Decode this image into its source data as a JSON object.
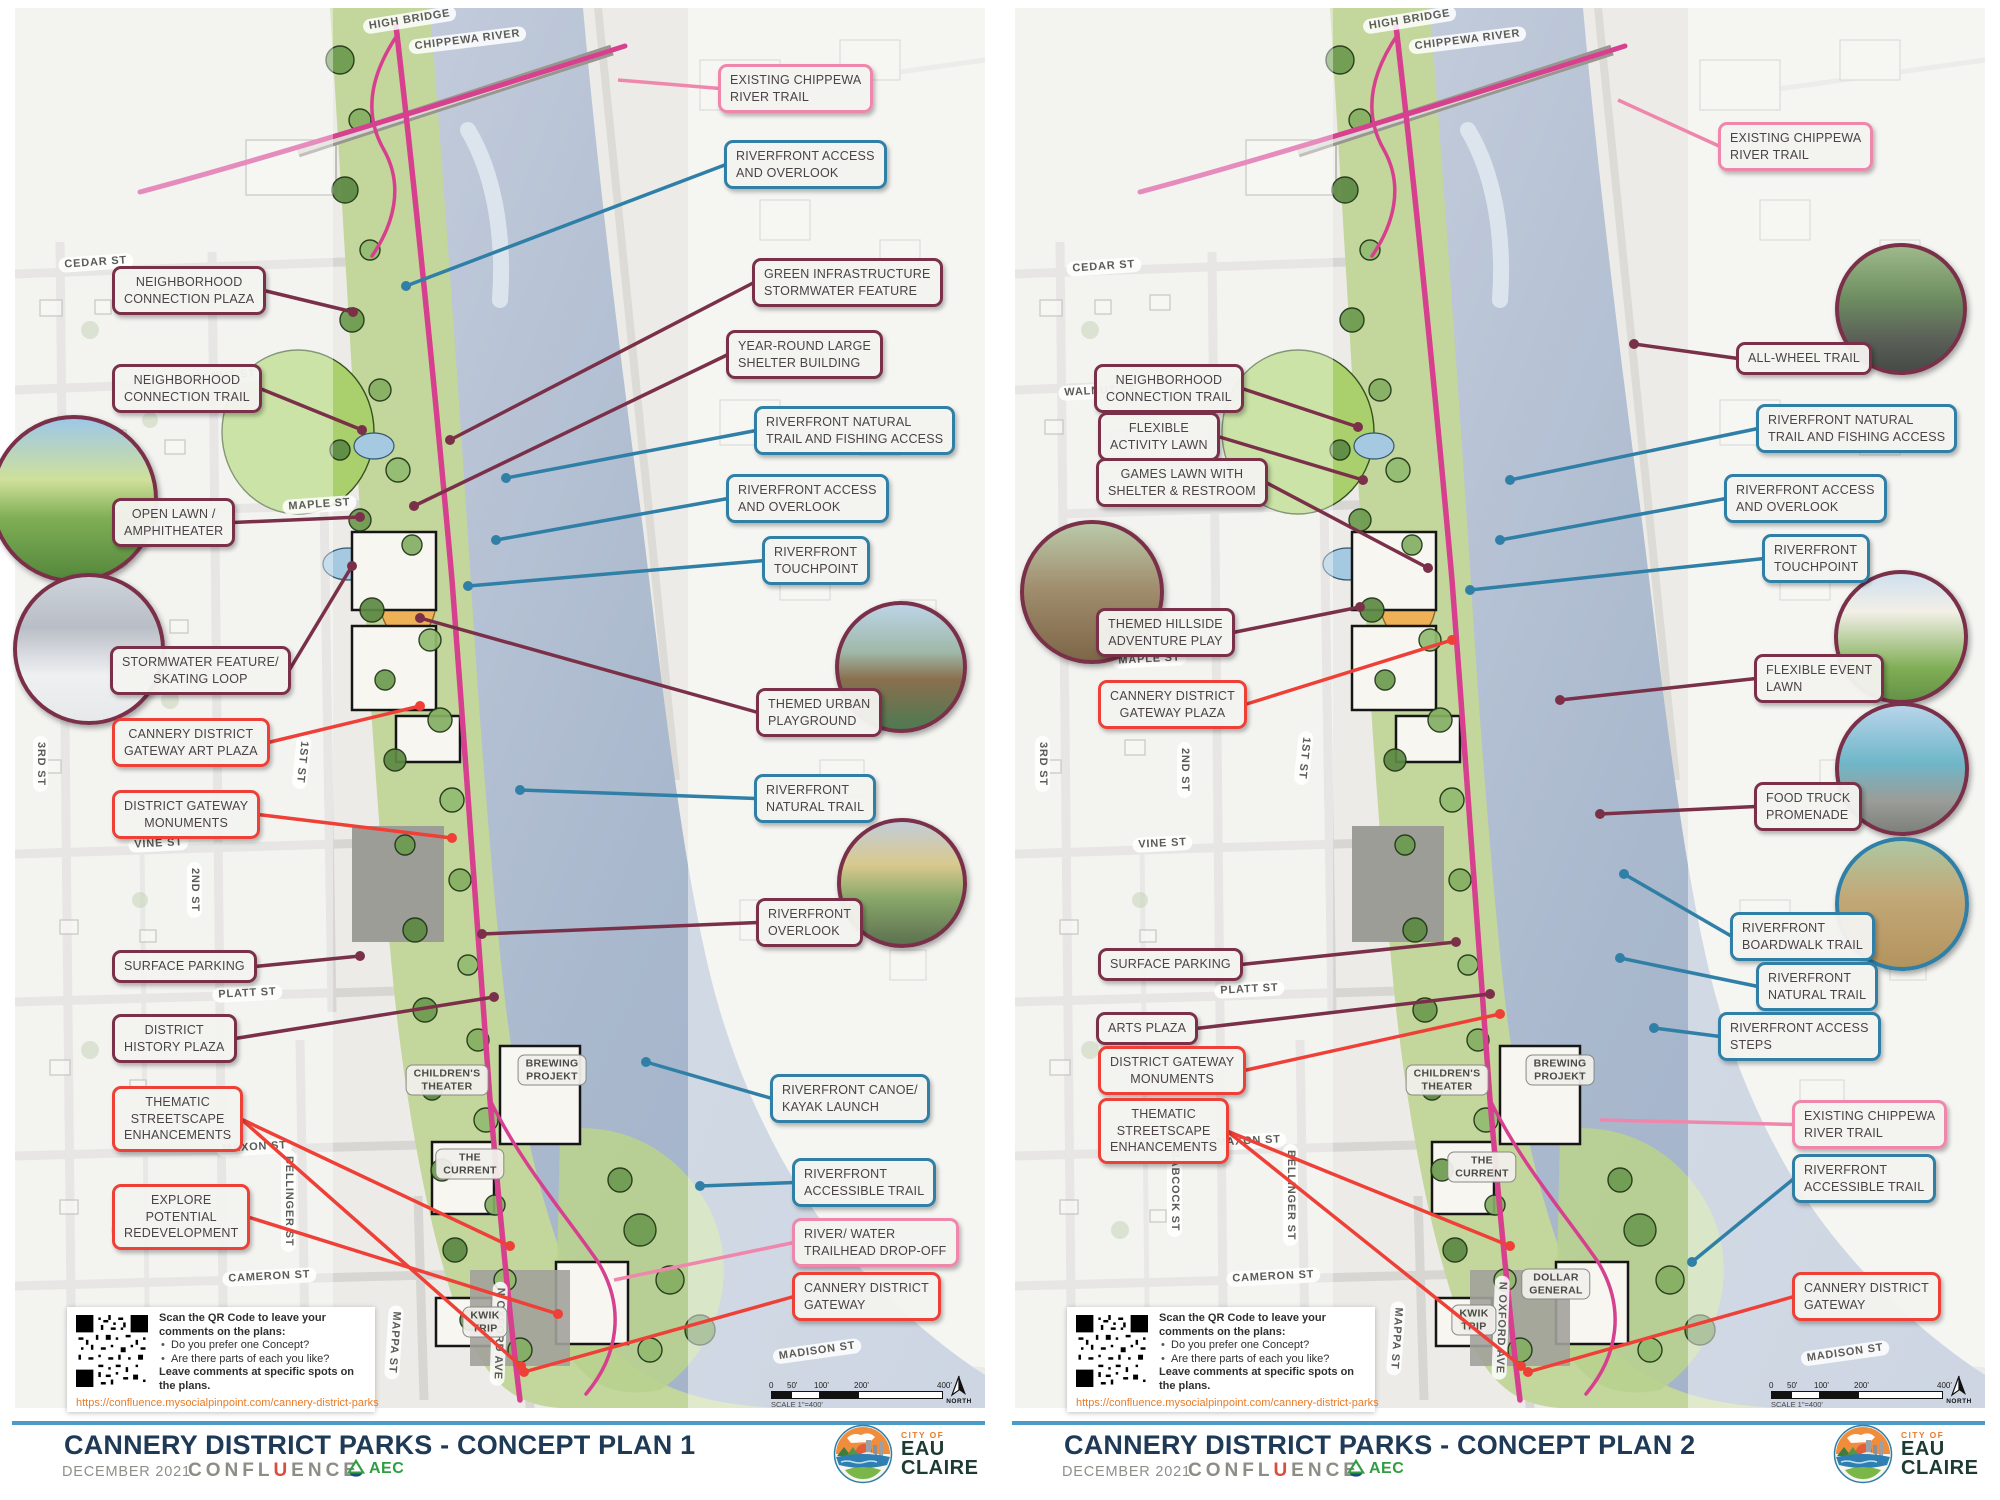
{
  "colors": {
    "maroon": "#7a3049",
    "red": "#ee4037",
    "blue": "#2f7fa7",
    "pink": "#ef87ad",
    "trail": "#d6408f",
    "navy": "#1e3a56",
    "divider": "#4a9cc7",
    "url_orange": "#e87b28"
  },
  "qr": {
    "heading": "Scan the QR Code to leave your comments on the plans:",
    "bullets": [
      "Do you prefer one Concept?",
      "Are there parts of each you like?"
    ],
    "note": "Leave comments at specific spots on the plans.",
    "url": "https://confluence.mysocialpinpoint.com/cannery-district-parks"
  },
  "scalebar": {
    "ticks": [
      "0",
      "50'",
      "100'",
      "200'",
      "400'"
    ],
    "label": "SCALE 1\"=400'",
    "north": "NORTH"
  },
  "footer": {
    "date": "DECEMBER 2021",
    "confluence": [
      "CONFL",
      "U",
      "ENCE"
    ],
    "aec": "AEC",
    "city_small": "CITY OF",
    "city_line1": "EAU",
    "city_line2": "CLAIRE"
  },
  "panels": [
    {
      "title": "CANNERY DISTRICT PARKS - CONCEPT PLAN 1",
      "streets": [
        {
          "t": "HIGH BRIDGE",
          "x": 362,
          "y": 20,
          "r": -9
        },
        {
          "t": "CHIPPEWA RIVER",
          "x": 408,
          "y": 40,
          "r": -7
        },
        {
          "t": "CEDAR ST",
          "x": 58,
          "y": 258,
          "r": -4
        },
        {
          "t": "WALNUT ST",
          "x": 178,
          "y": 372,
          "r": -4
        },
        {
          "t": "MAPLE ST",
          "x": 282,
          "y": 500,
          "r": -4
        },
        {
          "t": "VINE ST",
          "x": 128,
          "y": 838,
          "r": -3
        },
        {
          "t": "PLATT ST",
          "x": 212,
          "y": 988,
          "r": -3
        },
        {
          "t": "MAXON ST",
          "x": 216,
          "y": 1142,
          "r": -3
        },
        {
          "t": "CAMERON ST",
          "x": 222,
          "y": 1272,
          "r": -3
        },
        {
          "t": "MADISON ST",
          "x": 772,
          "y": 1350,
          "r": -8
        },
        {
          "t": "3RD ST",
          "x": 48,
          "y": 736,
          "r": 90
        },
        {
          "t": "2ND ST",
          "x": 202,
          "y": 862,
          "r": 90
        },
        {
          "t": "1ST ST",
          "x": 312,
          "y": 736,
          "r": 96
        },
        {
          "t": "BELLINGER ST",
          "x": 296,
          "y": 1150,
          "r": 90
        },
        {
          "t": "MAPPA ST",
          "x": 404,
          "y": 1306,
          "r": 94
        },
        {
          "t": "N OXFORD AVE",
          "x": 508,
          "y": 1282,
          "r": 92
        }
      ],
      "buildings": [
        {
          "t": "CHILDREN'S\nTHEATER",
          "x": 447,
          "y": 1080
        },
        {
          "t": "BREWING\nPROJEKT",
          "x": 552,
          "y": 1070
        },
        {
          "t": "THE\nCURRENT",
          "x": 470,
          "y": 1164
        },
        {
          "t": "KWIK\nTRIP",
          "x": 485,
          "y": 1322
        }
      ],
      "callouts": [
        {
          "text": "NEIGHBORHOOD\nCONNECTION PLAZA",
          "side": "left",
          "color": "maroon",
          "x": 112,
          "y": 266,
          "targets": [
            [
              353,
              312
            ]
          ]
        },
        {
          "text": "NEIGHBORHOOD\nCONNECTION TRAIL",
          "side": "left",
          "color": "maroon",
          "x": 112,
          "y": 364,
          "targets": [
            [
              362,
              430
            ]
          ]
        },
        {
          "text": "OPEN LAWN /\nAMPHITHEATER",
          "side": "left",
          "color": "maroon",
          "x": 112,
          "y": 498,
          "targets": [
            [
              360,
              517
            ]
          ]
        },
        {
          "text": "STORMWATER FEATURE/\nSKATING  LOOP",
          "side": "left",
          "color": "maroon",
          "x": 110,
          "y": 646,
          "targets": [
            [
              352,
              566
            ]
          ]
        },
        {
          "text": "CANNERY DISTRICT\nGATEWAY ART PLAZA",
          "side": "left",
          "color": "red",
          "x": 112,
          "y": 718,
          "targets": [
            [
              420,
              706
            ]
          ]
        },
        {
          "text": "DISTRICT GATEWAY\nMONUMENTS",
          "side": "left",
          "color": "red",
          "x": 112,
          "y": 790,
          "targets": [
            [
              452,
              838
            ]
          ]
        },
        {
          "text": "SURFACE PARKING",
          "side": "left",
          "color": "maroon",
          "x": 112,
          "y": 950,
          "targets": [
            [
              360,
              956
            ]
          ]
        },
        {
          "text": "DISTRICT\nHISTORY PLAZA",
          "side": "left",
          "color": "maroon",
          "x": 112,
          "y": 1014,
          "targets": [
            [
              494,
              997
            ]
          ]
        },
        {
          "text": "THEMATIC\nSTREETSCAPE\nENHANCEMENTS",
          "side": "left",
          "color": "red",
          "x": 112,
          "y": 1086,
          "targets": [
            [
              510,
              1246
            ],
            [
              521,
              1366
            ]
          ]
        },
        {
          "text": "EXPLORE\nPOTENTIAL\nREDEVELOPMENT",
          "side": "left",
          "color": "red",
          "x": 112,
          "y": 1184,
          "targets": [
            [
              558,
              1314
            ]
          ]
        },
        {
          "text": "EXISTING CHIPPEWA\nRIVER TRAIL",
          "side": "right",
          "color": "pink",
          "x": 718,
          "y": 64,
          "targets": [
            [
              618,
              80
            ]
          ]
        },
        {
          "text": "RIVERFRONT ACCESS\nAND  OVERLOOK",
          "side": "right",
          "color": "blue",
          "x": 724,
          "y": 140,
          "targets": [
            [
              406,
              286
            ]
          ]
        },
        {
          "text": "GREEN INFRASTRUCTURE\nSTORMWATER FEATURE",
          "side": "right",
          "color": "maroon",
          "x": 752,
          "y": 258,
          "targets": [
            [
              450,
              440
            ]
          ]
        },
        {
          "text": "YEAR-ROUND LARGE\nSHELTER BUILDING",
          "side": "right",
          "color": "maroon",
          "x": 726,
          "y": 330,
          "targets": [
            [
              414,
              506
            ]
          ]
        },
        {
          "text": "RIVERFRONT NATURAL\nTRAIL AND FISHING ACCESS",
          "side": "right",
          "color": "blue",
          "x": 754,
          "y": 406,
          "targets": [
            [
              506,
              478
            ]
          ]
        },
        {
          "text": "RIVERFRONT ACCESS\nAND  OVERLOOK",
          "side": "right",
          "color": "blue",
          "x": 726,
          "y": 474,
          "targets": [
            [
              496,
              540
            ]
          ]
        },
        {
          "text": "RIVERFRONT\nTOUCHPOINT",
          "side": "right",
          "color": "blue",
          "x": 762,
          "y": 536,
          "targets": [
            [
              468,
              586
            ]
          ]
        },
        {
          "text": "THEMED URBAN\nPLAYGROUND",
          "side": "right",
          "color": "maroon",
          "x": 756,
          "y": 688,
          "targets": [
            [
              420,
              618
            ]
          ]
        },
        {
          "text": "RIVERFRONT\nNATURAL TRAIL",
          "side": "right",
          "color": "blue",
          "x": 754,
          "y": 774,
          "targets": [
            [
              520,
              790
            ]
          ]
        },
        {
          "text": "RIVERFRONT\nOVERLOOK",
          "side": "right",
          "color": "maroon",
          "x": 756,
          "y": 898,
          "targets": [
            [
              482,
              934
            ]
          ]
        },
        {
          "text": "RIVERFRONT CANOE/\nKAYAK LAUNCH",
          "side": "right",
          "color": "blue",
          "x": 770,
          "y": 1074,
          "targets": [
            [
              646,
              1062
            ]
          ]
        },
        {
          "text": "RIVERFRONT\nACCESSIBLE TRAIL",
          "side": "right",
          "color": "blue",
          "x": 792,
          "y": 1158,
          "targets": [
            [
              700,
              1186
            ]
          ]
        },
        {
          "text": "RIVER/ WATER\nTRAILHEAD DROP-OFF",
          "side": "right",
          "color": "pink",
          "x": 792,
          "y": 1218,
          "targets": [
            [
              614,
              1280
            ]
          ]
        },
        {
          "text": "CANNERY DISTRICT\nGATEWAY",
          "side": "right",
          "color": "red",
          "x": 792,
          "y": 1272,
          "targets": [
            [
              524,
              1372
            ]
          ]
        }
      ],
      "photos": [
        {
          "kind": "lawn-event",
          "x": 70,
          "y": 495,
          "r": 80,
          "border": "maroon"
        },
        {
          "kind": "winter-walk",
          "x": 85,
          "y": 645,
          "r": 72,
          "border": "maroon"
        },
        {
          "kind": "playground",
          "x": 897,
          "y": 663,
          "r": 62,
          "border": "maroon"
        },
        {
          "kind": "overlook",
          "x": 898,
          "y": 879,
          "r": 61,
          "border": "maroon"
        }
      ]
    },
    {
      "title": "CANNERY DISTRICT PARKS - CONCEPT PLAN 2",
      "streets": [
        {
          "t": "HIGH BRIDGE",
          "x": 362,
          "y": 20,
          "r": -9
        },
        {
          "t": "CHIPPEWA RIVER",
          "x": 408,
          "y": 40,
          "r": -7
        },
        {
          "t": "CEDAR ST",
          "x": 66,
          "y": 262,
          "r": -4
        },
        {
          "t": "WALNUT ST",
          "x": 58,
          "y": 386,
          "r": -3
        },
        {
          "t": "MAPLE ST",
          "x": 112,
          "y": 654,
          "r": -3
        },
        {
          "t": "VINE ST",
          "x": 132,
          "y": 838,
          "r": -3
        },
        {
          "t": "PLATT ST",
          "x": 214,
          "y": 984,
          "r": -3
        },
        {
          "t": "MAXON ST",
          "x": 210,
          "y": 1136,
          "r": -3
        },
        {
          "t": "CAMERON ST",
          "x": 226,
          "y": 1272,
          "r": -3
        },
        {
          "t": "MADISON ST",
          "x": 800,
          "y": 1352,
          "r": -8
        },
        {
          "t": "3RD ST",
          "x": 50,
          "y": 736,
          "r": 90
        },
        {
          "t": "2ND ST",
          "x": 192,
          "y": 742,
          "r": 90
        },
        {
          "t": "1ST ST",
          "x": 314,
          "y": 732,
          "r": 96
        },
        {
          "t": "BABCOCK ST",
          "x": 182,
          "y": 1144,
          "r": 90
        },
        {
          "t": "BELLINGER ST",
          "x": 298,
          "y": 1144,
          "r": 90
        },
        {
          "t": "MAPPA ST",
          "x": 406,
          "y": 1302,
          "r": 94
        },
        {
          "t": "N OXFORD AVE",
          "x": 510,
          "y": 1276,
          "r": 92
        }
      ],
      "buildings": [
        {
          "t": "CHILDREN'S\nTHEATER",
          "x": 447,
          "y": 1080
        },
        {
          "t": "BREWING\nPROJEKT",
          "x": 560,
          "y": 1070
        },
        {
          "t": "THE\nCURRENT",
          "x": 482,
          "y": 1167
        },
        {
          "t": "KWIK\nTRIP",
          "x": 474,
          "y": 1320
        },
        {
          "t": "DOLLAR\nGENERAL",
          "x": 556,
          "y": 1284
        }
      ],
      "callouts": [
        {
          "text": "NEIGHBORHOOD\nCONNECTION TRAIL",
          "side": "left",
          "color": "maroon",
          "x": 94,
          "y": 364,
          "targets": [
            [
              358,
              427
            ]
          ]
        },
        {
          "text": "FLEXIBLE\nACTIVITY LAWN",
          "side": "left",
          "color": "maroon",
          "x": 98,
          "y": 412,
          "targets": [
            [
              363,
              480
            ]
          ]
        },
        {
          "text": "GAMES LAWN WITH\nSHELTER & RESTROOM",
          "side": "left",
          "color": "maroon",
          "x": 96,
          "y": 458,
          "targets": [
            [
              428,
              568
            ]
          ]
        },
        {
          "text": "THEMED HILLSIDE\nADVENTURE PLAY",
          "side": "left",
          "color": "maroon",
          "x": 96,
          "y": 608,
          "targets": [
            [
              360,
              607
            ]
          ]
        },
        {
          "text": "CANNERY DISTRICT\nGATEWAY PLAZA",
          "side": "left",
          "color": "red",
          "x": 98,
          "y": 680,
          "targets": [
            [
              452,
              640
            ]
          ]
        },
        {
          "text": "SURFACE PARKING",
          "side": "left",
          "color": "maroon",
          "x": 98,
          "y": 948,
          "targets": [
            [
              456,
              942
            ]
          ]
        },
        {
          "text": "ARTS PLAZA",
          "side": "left",
          "color": "maroon",
          "x": 96,
          "y": 1012,
          "targets": [
            [
              490,
              994
            ]
          ]
        },
        {
          "text": "DISTRICT GATEWAY\nMONUMENTS",
          "side": "left",
          "color": "red",
          "x": 98,
          "y": 1046,
          "targets": [
            [
              500,
              1014
            ]
          ]
        },
        {
          "text": "THEMATIC\nSTREETSCAPE\nENHANCEMENTS",
          "side": "left",
          "color": "red",
          "x": 98,
          "y": 1098,
          "targets": [
            [
              510,
              1246
            ],
            [
              521,
              1366
            ]
          ]
        },
        {
          "text": "EXISTING CHIPPEWA\nRIVER TRAIL",
          "side": "right",
          "color": "pink",
          "x": 718,
          "y": 122,
          "targets": [
            [
              618,
              100
            ]
          ]
        },
        {
          "text": "ALL-WHEEL TRAIL",
          "side": "right",
          "color": "maroon",
          "x": 736,
          "y": 342,
          "targets": [
            [
              634,
              344
            ]
          ]
        },
        {
          "text": "RIVERFRONT NATURAL\nTRAIL AND FISHING ACCESS",
          "side": "right",
          "color": "blue",
          "x": 756,
          "y": 404,
          "targets": [
            [
              510,
              480
            ]
          ]
        },
        {
          "text": "RIVERFRONT ACCESS\nAND  OVERLOOK",
          "side": "right",
          "color": "blue",
          "x": 724,
          "y": 474,
          "targets": [
            [
              500,
              540
            ]
          ]
        },
        {
          "text": "RIVERFRONT\nTOUCHPOINT",
          "side": "right",
          "color": "blue",
          "x": 762,
          "y": 534,
          "targets": [
            [
              470,
              590
            ]
          ]
        },
        {
          "text": "FLEXIBLE EVENT\nLAWN",
          "side": "right",
          "color": "maroon",
          "x": 754,
          "y": 654,
          "targets": [
            [
              560,
              700
            ]
          ]
        },
        {
          "text": "FOOD TRUCK\nPROMENADE",
          "side": "right",
          "color": "maroon",
          "x": 754,
          "y": 782,
          "targets": [
            [
              600,
              814
            ]
          ]
        },
        {
          "text": "RIVERFRONT\nBOARDWALK TRAIL",
          "side": "right",
          "color": "blue",
          "x": 730,
          "y": 912,
          "targets": [
            [
              624,
              874
            ]
          ]
        },
        {
          "text": "RIVERFRONT\nNATURAL TRAIL",
          "side": "right",
          "color": "blue",
          "x": 756,
          "y": 962,
          "targets": [
            [
              620,
              958
            ]
          ]
        },
        {
          "text": "RIVERFRONT ACCESS\nSTEPS",
          "side": "right",
          "color": "blue",
          "x": 718,
          "y": 1012,
          "targets": [
            [
              654,
              1028
            ]
          ]
        },
        {
          "text": "EXISTING CHIPPEWA\nRIVER TRAIL",
          "side": "right",
          "color": "pink",
          "x": 792,
          "y": 1100,
          "targets": [
            [
              600,
              1120
            ]
          ]
        },
        {
          "text": "RIVERFRONT\nACCESSIBLE TRAIL",
          "side": "right",
          "color": "blue",
          "x": 792,
          "y": 1154,
          "targets": [
            [
              692,
              1262
            ]
          ]
        },
        {
          "text": "CANNERY DISTRICT\nGATEWAY",
          "side": "right",
          "color": "red",
          "x": 792,
          "y": 1272,
          "targets": [
            [
              528,
              1372
            ]
          ]
        }
      ],
      "photos": [
        {
          "kind": "hillside",
          "x": 88,
          "y": 588,
          "r": 68,
          "border": "maroon"
        },
        {
          "kind": "scooter",
          "x": 897,
          "y": 305,
          "r": 62,
          "border": "maroon"
        },
        {
          "kind": "artfair",
          "x": 897,
          "y": 633,
          "r": 63,
          "border": "maroon"
        },
        {
          "kind": "foodtruck",
          "x": 898,
          "y": 765,
          "r": 63,
          "border": "maroon"
        },
        {
          "kind": "boardwalk",
          "x": 898,
          "y": 900,
          "r": 63,
          "border": "blue"
        }
      ]
    }
  ]
}
